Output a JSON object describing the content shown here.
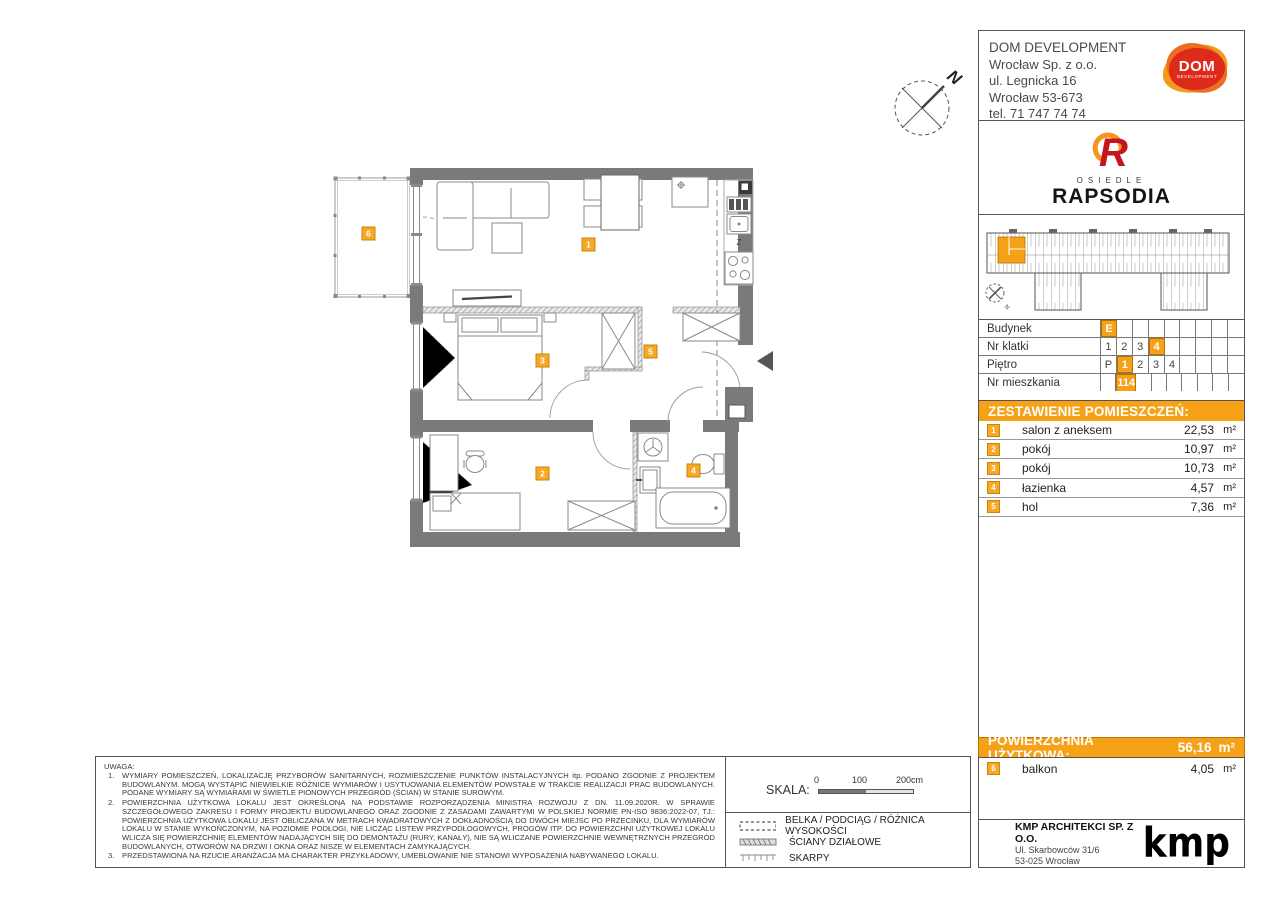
{
  "developer": {
    "name": "DOM DEVELOPMENT",
    "line2": "Wrocław Sp. z o.o.",
    "line3": "ul. Legnicka 16",
    "line4": "Wrocław 53-673",
    "line5": "tel. 71 747 74 74",
    "logo_top": "DOM",
    "logo_bottom": "DEVELOPMENT"
  },
  "estate": {
    "label": "OSIEDLE",
    "name": "RAPSODIA"
  },
  "site_plan": {
    "north_label": "N"
  },
  "unit_info": {
    "rows": [
      {
        "label": "Budynek",
        "cells": [
          "E",
          "",
          "",
          "",
          "",
          "",
          "",
          "",
          ""
        ],
        "highlighted_index": 0
      },
      {
        "label": "Nr klatki",
        "cells": [
          "1",
          "2",
          "3",
          "4",
          "",
          "",
          "",
          "",
          ""
        ],
        "highlighted_index": 3
      },
      {
        "label": "Piętro",
        "cells": [
          "P",
          "1",
          "2",
          "3",
          "4",
          "",
          "",
          "",
          ""
        ],
        "highlighted_index": 1
      },
      {
        "label": "Nr mieszkania",
        "cells": [
          "",
          "114",
          "",
          "",
          "",
          "",
          "",
          "",
          ""
        ],
        "highlighted_index": 1
      }
    ]
  },
  "rooms": {
    "header": "ZESTAWIENIE POMIESZCZEŃ:",
    "unit": "m²",
    "items": [
      {
        "no": "1",
        "label": "salon z aneksem",
        "area": "22,53",
        "unit": "m²"
      },
      {
        "no": "2",
        "label": "pokój",
        "area": "10,97",
        "unit": "m²"
      },
      {
        "no": "3",
        "label": "pokój",
        "area": "10,73",
        "unit": "m²"
      },
      {
        "no": "4",
        "label": "łazienka",
        "area": "4,57",
        "unit": "m²"
      },
      {
        "no": "5",
        "label": "hol",
        "area": "7,36",
        "unit": "m²"
      }
    ]
  },
  "total": {
    "label": "POWIERZCHNIA UŻYTKOWA:",
    "area": "56,16",
    "unit": "m²"
  },
  "extras": {
    "items": [
      {
        "no": "6",
        "label": "balkon",
        "area": "4,05",
        "unit": "m²"
      }
    ]
  },
  "plan": {
    "badges": [
      "1",
      "2",
      "3",
      "4",
      "5",
      "6"
    ],
    "kitchen_z_label": "Z",
    "north_label": "N"
  },
  "scale": {
    "label": "SKALA:",
    "tick0": "0",
    "tick1": "100",
    "tick2": "200cm"
  },
  "legend": {
    "items": [
      "BELKA / PODCIĄG / RÓŻNICA WYSOKOŚCI",
      "ŚCIANY DZIAŁOWE",
      "SKARPY"
    ]
  },
  "architect": {
    "name": "KMP ARCHITEKCI SP. Z O.O.",
    "addr1": "Ul. Skarbowców 31/6",
    "addr2": "53-025 Wrocław",
    "logo": "kmp"
  },
  "notes": {
    "title": "UWAGA:",
    "items": [
      "WYMIARY POMIESZCZEŃ, LOKALIZACJĘ PRZYBORÓW SANITARNYCH, ROZMIESZCZENIE PUNKTÓW INSTALACYJNYCH itp. PODANO ZGODNIE Z PROJEKTEM BUDOWLANYM. MOGĄ WYSTĄPIĆ NIEWIELKIE RÓŻNICE WYMIARÓW I USYTUOWANIA ELEMENTÓW POWSTAŁE W TRAKCIE REALIZACJI PRAC BUDOWLANYCH. PODANE WYMIARY SĄ WYMIARAMI W ŚWIETLE PIONOWYCH PRZEGRÓD (ŚCIAN) W STANIE SUROWYM.",
      "POWIERZCHNIA UŻYTKOWA LOKALU JEST OKREŚLONA NA PODSTAWIE ROZPORZĄDZENIA MINISTRA ROZWOJU Z DN. 11.09.2020R. W SPRAWIE SZCZEGÓŁOWEGO ZAKRESU I FORMY PROJEKTU BUDOWLANEGO ORAZ ZGODNIE Z ZASADAMI ZAWARTYMI W POLSKIEJ NORMIE PN-ISO 9836:2022-07, TJ.: POWIERZCHNIA UŻYTKOWA LOKALU JEST OBLICZANA W METRACH KWADRATOWYCH Z DOKŁADNOŚCIĄ DO DWÓCH MIEJSC PO PRZECINKU, DLA WYMIARÓW LOKALU W STANIE WYKOŃCZONYM, NA POZIOMIE PODŁOGI, NIE LICZĄC LISTEW PRZYPODŁOGOWYCH, PROGÓW ITP. DO POWIERZCHNI UŻYTKOWEJ LOKALU WLICZA SIĘ POWIERZCHNIĘ ELEMENTÓW NADAJĄCYCH SIĘ DO DEMONTAŻU (RURY, KANAŁY), NIE SĄ WLICZANE POWIERZCHNIE WEWNĘTRZNYCH PRZEGRÓD BUDOWLANYCH, OTWORÓW NA DRZWI I OKNA ORAZ NISZE W ELEMENTACH ZAMYKAJĄCYCH.",
      "PRZEDSTAWIONA NA RZUCIE ARANŻACJA MA CHARAKTER PRZYKŁADOWY, UMEBLOWANIE NIE STANOWI WYPOSAŻENIA NABYWANEGO LOKALU."
    ]
  },
  "colors": {
    "accent": "#F6A117",
    "badge": "#F9A825",
    "wall": "#7a7a7a"
  }
}
